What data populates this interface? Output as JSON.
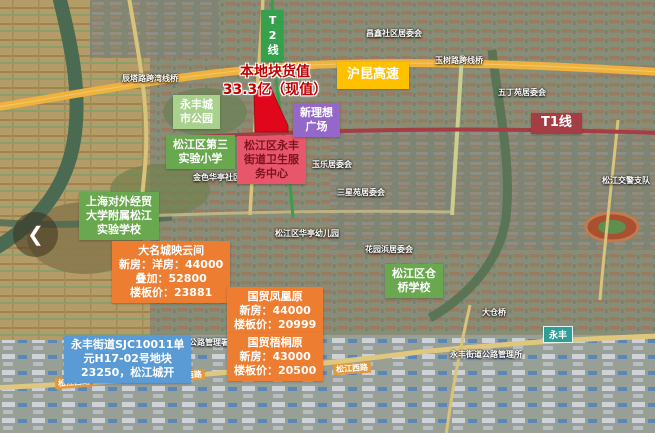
{
  "back_button": {
    "symbol": "❮"
  },
  "transit": {
    "t2_label": "T2线",
    "t1_label": "T1线",
    "highway_label": "沪昆高速"
  },
  "headline": {
    "line1": "本地块货值",
    "line2": "33.3亿（现值）"
  },
  "places": [
    {
      "id": "yongfeng-park",
      "lines": [
        "永丰城",
        "市公园"
      ]
    },
    {
      "id": "third-experimental-school",
      "lines": [
        "松江区第三",
        "实验小学"
      ]
    },
    {
      "id": "health-center",
      "lines": [
        "松江区永丰",
        "街道卫生服",
        "务中心"
      ]
    },
    {
      "id": "xinlixiang-plaza",
      "lines": [
        "新理想",
        "广场"
      ]
    },
    {
      "id": "suibe-school",
      "lines": [
        "上海对外经贸",
        "大学附属松江",
        "实验学校"
      ]
    },
    {
      "id": "cangqiao-school",
      "lines": [
        "松江区仓",
        "桥学校"
      ]
    }
  ],
  "projects": [
    {
      "name": "大名城映云间",
      "lines": [
        "新房：洋房：44000",
        "叠加：52800",
        "楼板价：23881"
      ]
    },
    {
      "name": "国贸凤凰原",
      "lines": [
        "新房：44000",
        "楼板价：20999"
      ]
    },
    {
      "name": "国贸梧桐原",
      "lines": [
        "新房：43000",
        "楼板价：20500"
      ]
    }
  ],
  "parcel_listing": {
    "lines": [
      "永丰街道SJC10011单",
      "元H17-02号地块",
      "23250，松江城开"
    ]
  },
  "map_labels": [
    "辰塔路跨湾线桥",
    "玉树路跨线桥",
    "昌鑫社区居委会",
    "五丁苑居委会",
    "玉乐居委会",
    "金色华亭社区居委会",
    "三星苑居委会",
    "松江区华亭幼儿园",
    "花园浜居委会",
    "大仓桥",
    "永丰街道公路管理所",
    "松江区公路管理署",
    "松江交警支队"
  ],
  "road_labels": {
    "songjiang_west_road": "松江西路"
  },
  "station_badge": {
    "text": "永丰"
  },
  "colors": {
    "green_label": "#6AA84F",
    "light_green_label": "#A9D18E",
    "pink_label": "#E8566B",
    "purple_label": "#9468C8",
    "orange_label": "#ED7D31",
    "blue_label": "#5B9BD5",
    "highway_yellow": "#FFC000",
    "t1_red": "#A43E44",
    "t2_green": "#36A14C",
    "parcel_red": "#E0071C",
    "headline_red": "#C00000"
  }
}
